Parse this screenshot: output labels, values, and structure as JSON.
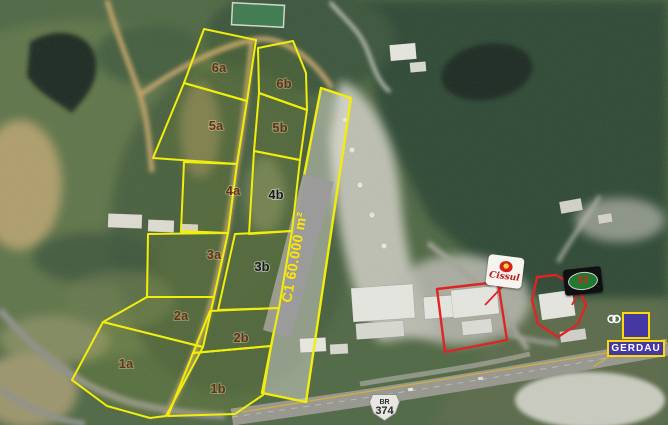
{
  "map": {
    "width": 668,
    "height": 425,
    "outline_color": "#f2ee0c",
    "label_color": "#6b3113",
    "alt_label_color": "#1a1a1a",
    "plots": [
      {
        "id": "6a",
        "points": "204,29 256,40 247,101 184,83",
        "lx": 219,
        "ly": 72
      },
      {
        "id": "5a",
        "points": "184,83 247,101 237,164 153,158",
        "lx": 216,
        "ly": 130
      },
      {
        "id": "4a",
        "points": "184,162 237,164 228,233 181,231",
        "lx": 233,
        "ly": 195
      },
      {
        "id": "3a",
        "points": "148,234 228,233 214,297 147,297",
        "lx": 214,
        "ly": 259
      },
      {
        "id": "2a",
        "points": "147,297 214,297 203,347 103,322",
        "lx": 181,
        "ly": 320
      },
      {
        "id": "1a",
        "points": "103,322 203,347 166,416 150,418 107,406 72,380",
        "lx": 126,
        "ly": 368
      },
      {
        "id": "6b",
        "points": "258,48 293,41 306,73 307,110 259,93",
        "lx": 284,
        "ly": 88
      },
      {
        "id": "5b",
        "points": "259,93 307,110 300,160 254,151",
        "lx": 280,
        "ly": 132
      },
      {
        "id": "4b",
        "points": "254,151 300,160 292,231 249,234",
        "lx": 276,
        "ly": 199,
        "alt": true
      },
      {
        "id": "3b",
        "points": "235,234 292,231 279,308 218,310",
        "lx": 262,
        "ly": 271,
        "alt": true
      },
      {
        "id": "2b",
        "points": "210,311 279,308 271,346 193,353",
        "lx": 241,
        "ly": 342
      },
      {
        "id": "1b",
        "points": "193,353 271,346 263,395 235,414 168,416",
        "lx": 218,
        "ly": 393
      }
    ],
    "strip": {
      "points": "321,88 351,98 306,402 262,393",
      "band_points": "303,174 334,182 291,338 263,330",
      "band_color": "#9b9b9b",
      "label": "C1 60.000 m²",
      "label_color": "#ffe600",
      "label_x": 299,
      "label_y": 258,
      "label_rotate": -80
    },
    "red_lots": {
      "color": "#e02424",
      "shapes": [
        "437,289 498,282 507,340 445,352",
        "537,277 556,275 578,288 586,305 578,324 558,337 538,324 532,300"
      ],
      "pointers": [
        "503,286 485,305",
        "578,293 572,305"
      ]
    },
    "yellow_lines": [
      "242,412 668,343",
      "618,351 593,367"
    ]
  },
  "signs": {
    "cissul": {
      "label": "Cissul",
      "text_color": "#c41616"
    },
    "lot53": {
      "label": "53",
      "text_color": "#e02020",
      "oval_color": "#1e7a2e"
    },
    "gerdau": {
      "label": "GERDAU",
      "bg": "#4638a2",
      "border": "#ffd80a"
    },
    "road_shield": {
      "prefix": "BR",
      "number": "374"
    }
  }
}
